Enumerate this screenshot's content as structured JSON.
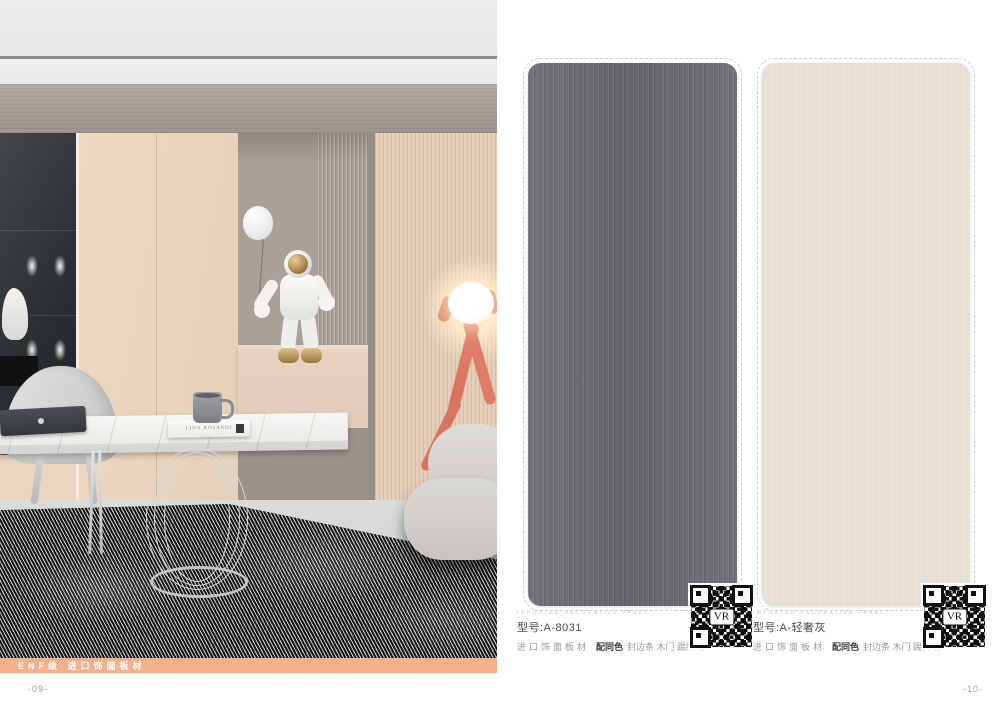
{
  "left_page": {
    "banner": {
      "label": "ENF级 进口饰面板材",
      "bg": "#f5b08c"
    },
    "page_number": "-09-",
    "scene": {
      "book_title": "LINA ROSARDI"
    }
  },
  "right_page": {
    "page_number": "-10-",
    "swatches": [
      {
        "eyebrow": "IMPORTED DECORATIVE PANEL",
        "model": "型号:A-8031",
        "desc_panel": "进口饰面板材",
        "desc_bold": "配同色",
        "desc_rest": "封边条 木门 踢脚线",
        "color": "#6c6b71",
        "qr_label": "VR"
      },
      {
        "eyebrow": "IMPORTED DECORATIVE PANEL",
        "model": "型号:A-轻奢灰",
        "desc_panel": "进口饰面板材",
        "desc_bold": "配同色",
        "desc_rest": "封边条 木门 踢脚线",
        "color": "#e8e2d6",
        "qr_label": "VR"
      }
    ]
  }
}
